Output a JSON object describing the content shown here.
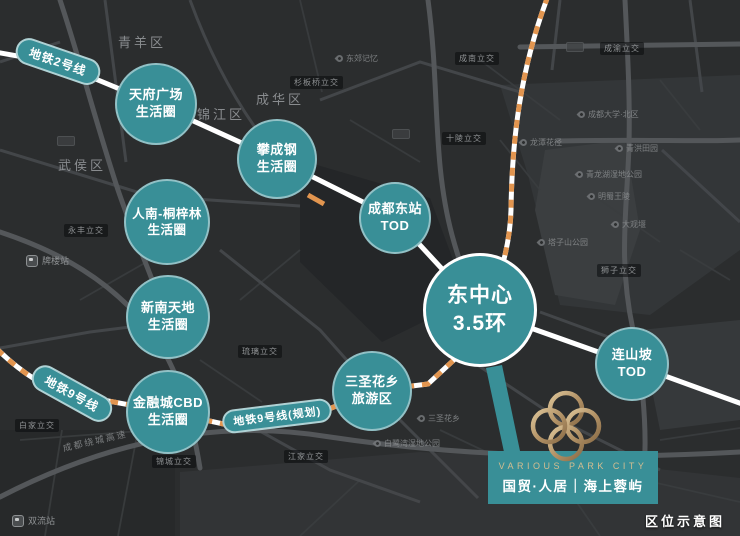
{
  "caption": "区位示意图",
  "colors": {
    "background": "#2B2D2E",
    "teal": "#398F97",
    "gold": "#C2A372",
    "stripe_orange": "#E2954F",
    "metro_line_white": "#FFFFFF"
  },
  "metro_pills": [
    {
      "label": "地铁2号线"
    },
    {
      "label": "地铁9号线"
    },
    {
      "label": "地铁9号线(规划)"
    }
  ],
  "circles": [
    {
      "name": "tianfu-square",
      "line1": "天府广场",
      "line2": "生活圈"
    },
    {
      "name": "panchenggang",
      "line1": "攀成钢",
      "line2": "生活圈"
    },
    {
      "name": "rennan-tongzilin",
      "line1": "人南-桐梓林",
      "line2": "生活圈"
    },
    {
      "name": "xinnan-tiandi",
      "line1": "新南天地",
      "line2": "生活圈"
    },
    {
      "name": "financial-city-cbd",
      "line1": "金融城CBD",
      "line2": "生活圈"
    },
    {
      "name": "sansheng-huaxiang",
      "line1": "三圣花乡",
      "line2": "旅游区"
    },
    {
      "name": "chengdu-east-station",
      "line1": "成都东站",
      "line2": "TOD"
    },
    {
      "name": "east-center",
      "line1": "东中心",
      "line2": "3.5环"
    },
    {
      "name": "lianshanpo",
      "line1": "连山坡",
      "line2": "TOD"
    }
  ],
  "districts": [
    {
      "label": "青羊区"
    },
    {
      "label": "成华区"
    },
    {
      "label": "锦江区"
    },
    {
      "label": "武侯区"
    }
  ],
  "interchanges": [
    {
      "label": "成南立交"
    },
    {
      "label": "杉板桥立交"
    },
    {
      "label": "十陵立交"
    },
    {
      "label": "成渝立交"
    },
    {
      "label": "永丰立交"
    },
    {
      "label": "白家立交"
    },
    {
      "label": "琉璃立交"
    },
    {
      "label": "狮子立交"
    },
    {
      "label": "江家立交"
    },
    {
      "label": "锦城立交"
    }
  ],
  "pois": [
    {
      "label": "东郊记忆"
    },
    {
      "label": "成都大学·北区"
    },
    {
      "label": "龙潭花径"
    },
    {
      "label": "青洪田园"
    },
    {
      "label": "青龙湖湿地公园"
    },
    {
      "label": "明蜀王陵"
    },
    {
      "label": "大观堰"
    },
    {
      "label": "塔子山公园"
    },
    {
      "label": "三圣花乡"
    },
    {
      "label": "白鹭湾湿地公园"
    }
  ],
  "stations": [
    {
      "label": "牌楼站"
    },
    {
      "label": "双流站"
    }
  ],
  "road_label": "成都绕城高速",
  "logo": {
    "brand_en": "VARIOUS PARK CITY",
    "brand_cn": "国贸·人居｜海上蓉屿"
  }
}
